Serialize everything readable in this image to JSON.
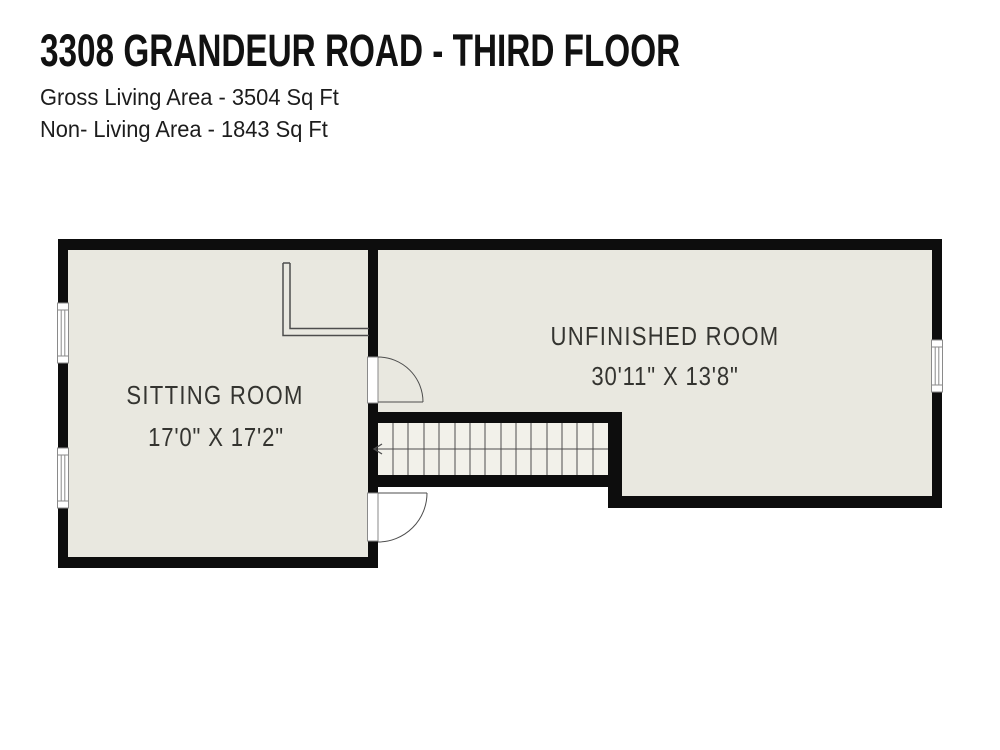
{
  "header": {
    "title": "3308 GRANDEUR ROAD - THIRD FLOOR",
    "gross_living_area": "Gross Living Area - 3504 Sq Ft",
    "non_living_area": "Non- Living Area - 1843 Sq Ft"
  },
  "floor_plan": {
    "rooms": [
      {
        "name": "SITTING ROOM",
        "dimensions": "17'0\" X 17'2\""
      },
      {
        "name": "UNFINISHED ROOM",
        "dimensions": "30'11\" X 13'8\""
      }
    ],
    "stairs": {
      "direction_arrow": "left"
    },
    "colors": {
      "wall": "#0d0d0d",
      "room_fill": "#e9e8e0",
      "stair_fill": "#f2f1ea",
      "line": "#4d4d4d",
      "symbol_stroke": "#8a8a8a",
      "label_text": "#343430"
    }
  }
}
